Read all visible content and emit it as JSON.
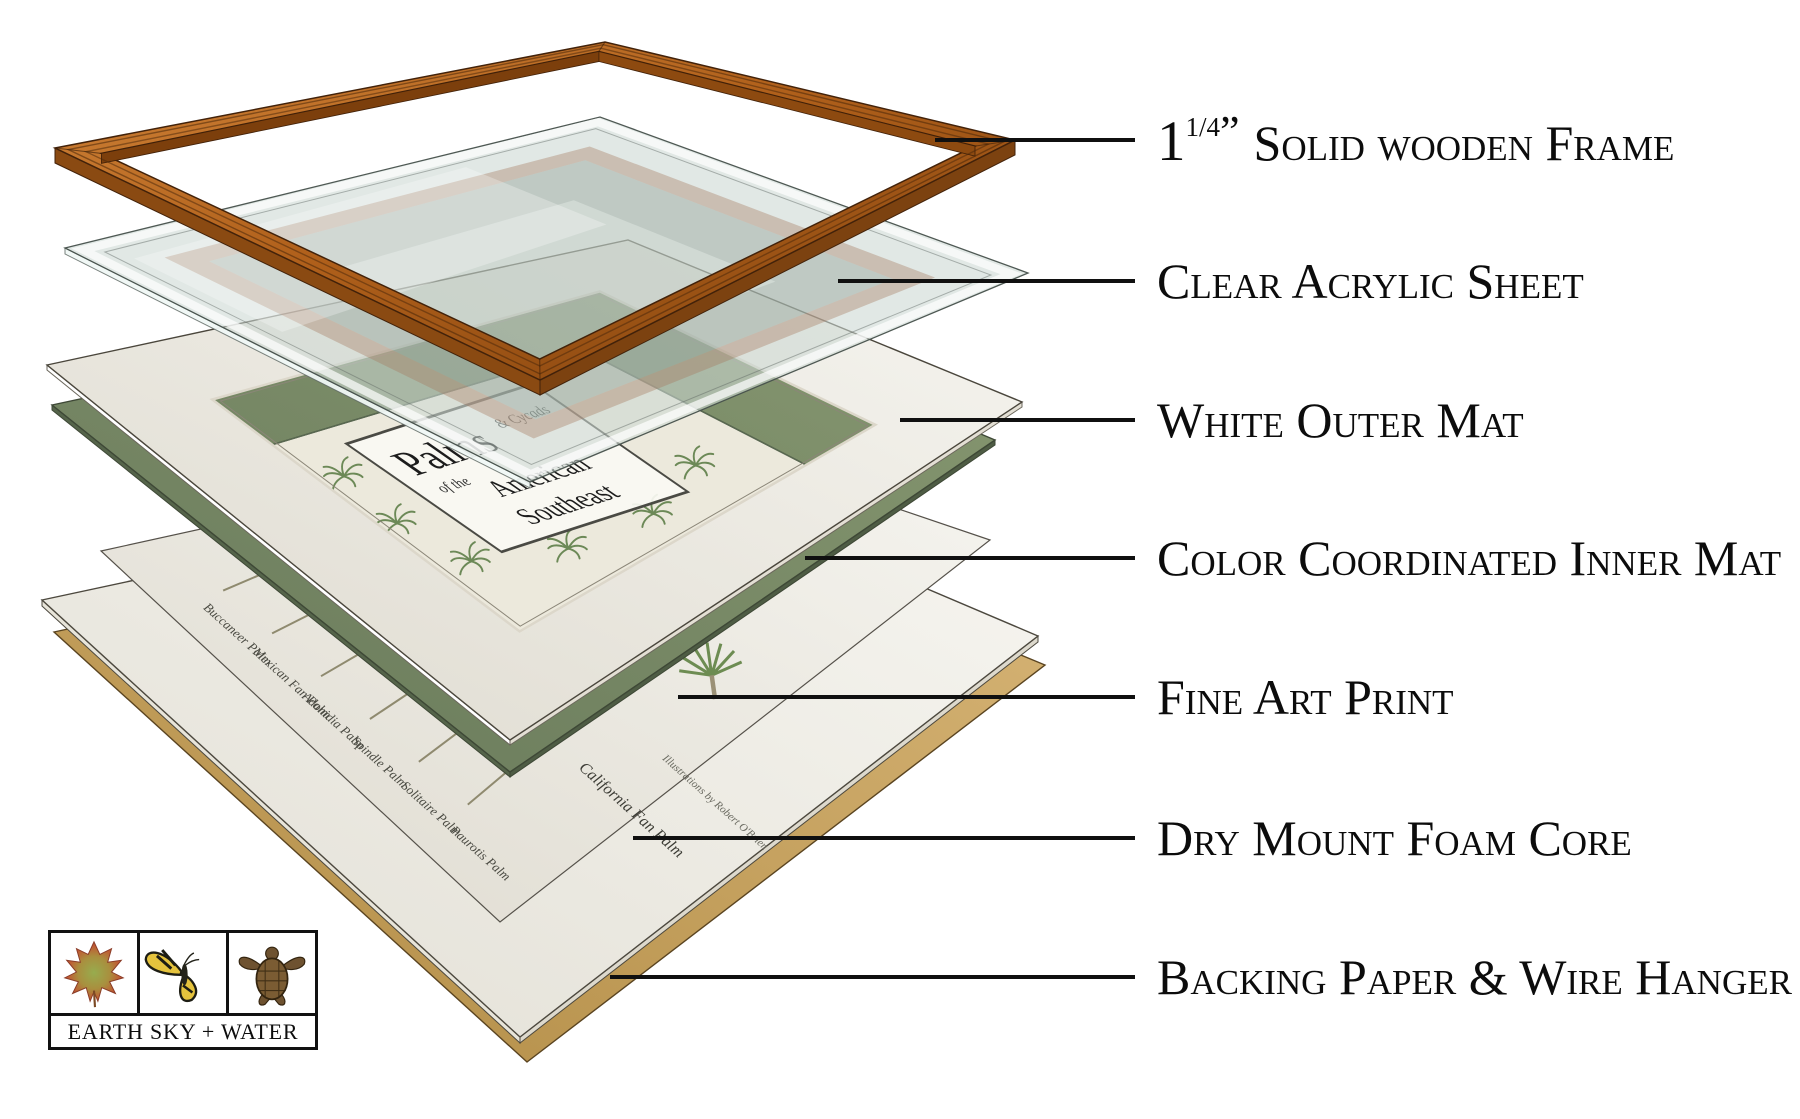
{
  "diagram": {
    "callouts": [
      {
        "id": "wood-frame",
        "label": "Solid wooden Frame"
      },
      {
        "id": "acrylic",
        "label": "Clear Acrylic Sheet"
      },
      {
        "id": "outer-mat",
        "label": "White Outer Mat"
      },
      {
        "id": "inner-mat",
        "label": "Color Coordinated Inner Mat"
      },
      {
        "id": "art-print",
        "label": "Fine Art Print"
      },
      {
        "id": "foam-core",
        "label": "Dry Mount Foam Core"
      },
      {
        "id": "backing",
        "label": "Backing Paper & Wire Hanger"
      }
    ],
    "frame_measurement": {
      "value": "1",
      "fraction": "1/4",
      "unit": "”"
    },
    "artwork": {
      "title_word1": "Palms",
      "title_word2": "& Cycads",
      "title_word3": "of the",
      "title_word4": "American",
      "title_word5": "Southeast",
      "palm_labels": [
        "Buccaneer Palm",
        "Mexican Fan Palm",
        "Adonidia Palm",
        "Spindle Palm",
        "Solitaire Palm",
        "Paurotis Palm"
      ],
      "featured_label": "California Fan Palm",
      "credit": "Illustrations by Robert O'Brien"
    },
    "colors": {
      "wood_light": "#d28539",
      "wood_mid": "#b0601b",
      "wood_dark": "#81420d",
      "wood_side": "#8a4a12",
      "acrylic": "#cbd8d2",
      "outer_mat_light": "#f6f5f0",
      "outer_mat_dark": "#dedacf",
      "inner_mat_light": "#879871",
      "inner_mat_dark": "#68795a",
      "paper": "#ece9dc",
      "foam_light": "#f7f6f1",
      "foam_dark": "#e2dfd5",
      "backing_light": "#d8b678",
      "backing_dark": "#b08a43",
      "leader_line": "#101010"
    }
  },
  "logo": {
    "text": "EARTH SKY + WATER",
    "icons": [
      {
        "name": "maple-leaf-icon"
      },
      {
        "name": "butterfly-icon"
      },
      {
        "name": "sea-turtle-icon"
      }
    ]
  }
}
